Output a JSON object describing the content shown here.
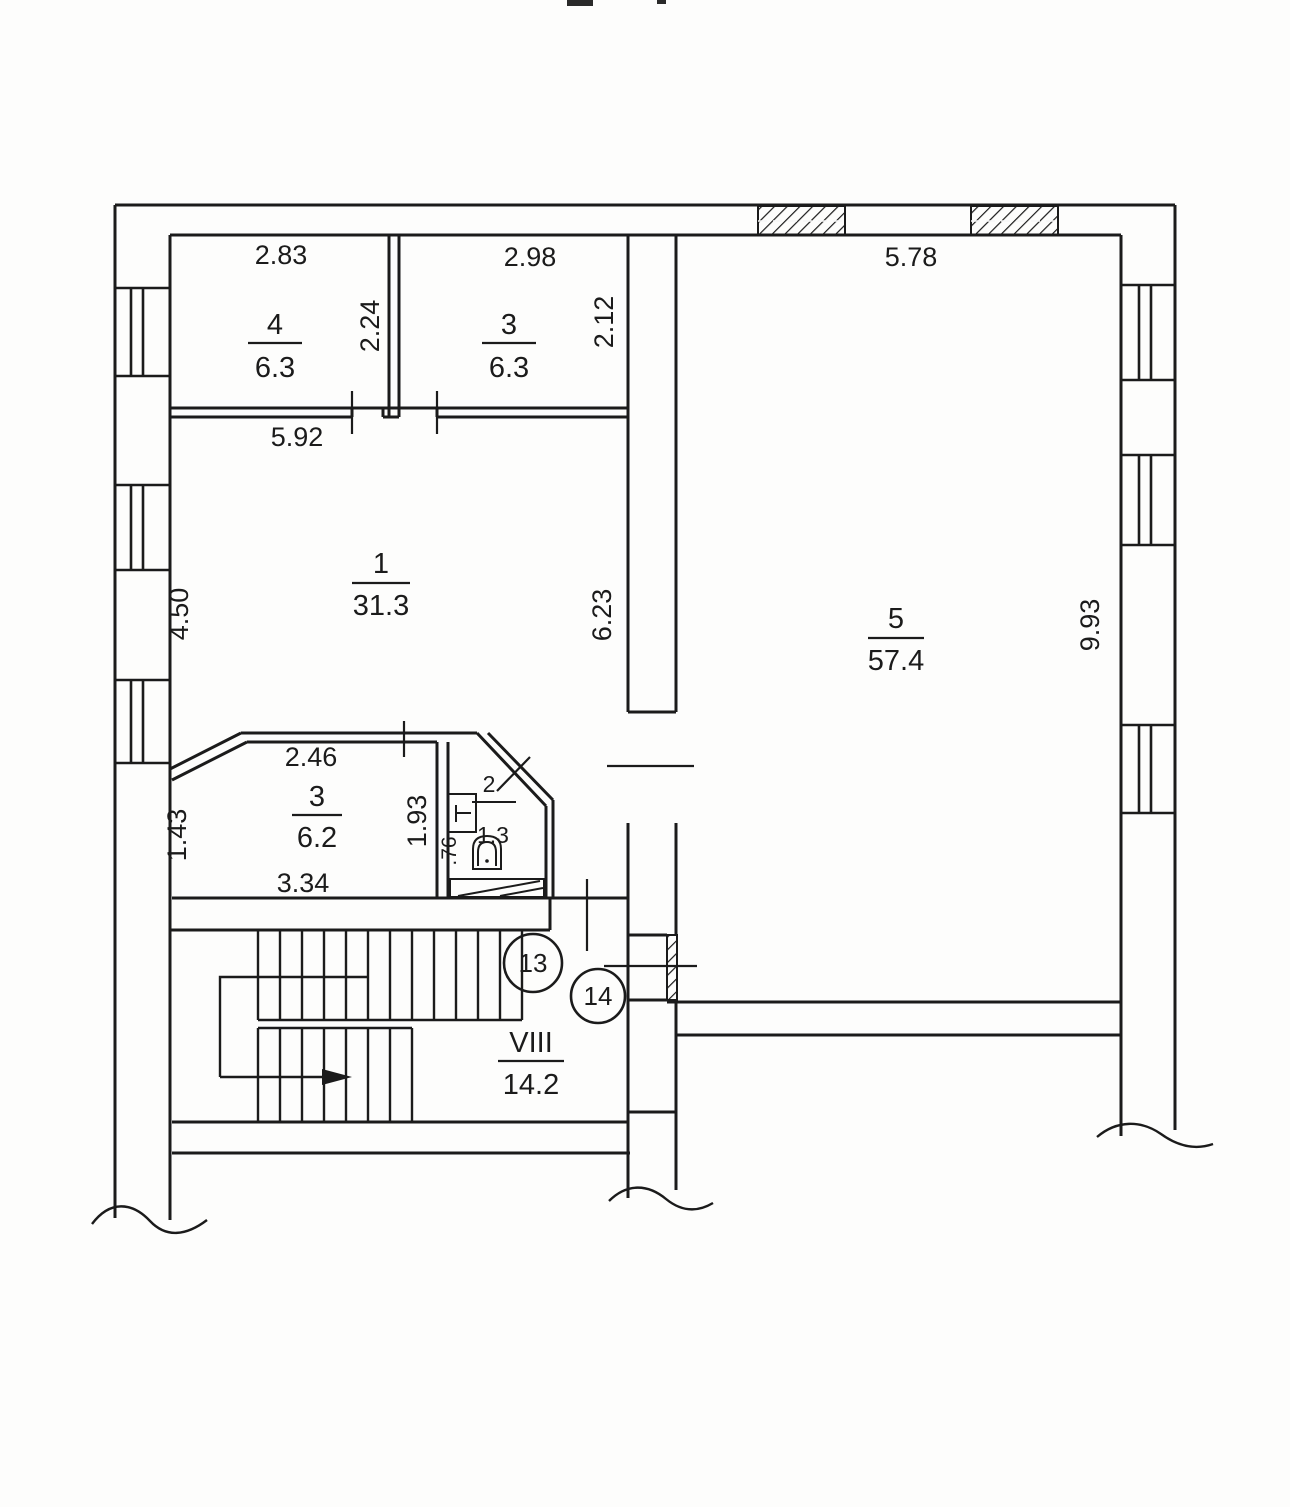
{
  "plan": {
    "kind": "apartment-floor-plan-scan",
    "colors": {
      "line": "#1b1b1b",
      "paper": "#fdfdfc"
    },
    "rooms": {
      "room4": {
        "number": "4",
        "area": "6.3"
      },
      "room3_top": {
        "number": "3",
        "area": "6.3"
      },
      "room1": {
        "number": "1",
        "area": "31.3"
      },
      "room5": {
        "number": "5",
        "area": "57.4"
      },
      "room3_bottom": {
        "number": "3",
        "area": "6.2"
      },
      "bathroom": {
        "number": "2",
        "area": "1.3"
      },
      "stair_hall": {
        "number": "VIII",
        "area": "14.2"
      }
    },
    "dimensions": {
      "room4_width": "2.83",
      "room4_depth": "2.24",
      "room3_top_width": "2.98",
      "room3_top_depth": "2.12",
      "room1_top_width": "5.92",
      "room1_left_depth": "4.50",
      "room1_right_depth": "6.23",
      "room5_width": "5.78",
      "room5_depth": "9.93",
      "room3_bottom_top": "2.46",
      "room3_bottom_left": "1.43",
      "room3_bottom_width": "3.34",
      "bathroom_depth": "1.93",
      "bathroom_width": ".76"
    },
    "door_marks": {
      "d13": "13",
      "d14": "14"
    }
  }
}
